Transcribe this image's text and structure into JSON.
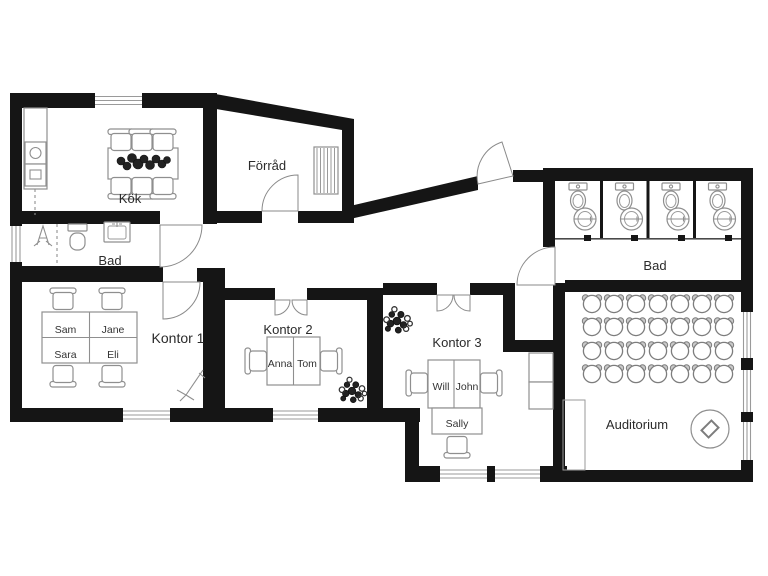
{
  "type": "floor-plan",
  "colors": {
    "wall": "#151515",
    "furniture_stroke": "#8f8f8f",
    "text": "#2b2b2b",
    "background": "#ffffff"
  },
  "rooms": {
    "kok": {
      "label": "Kök"
    },
    "forrad": {
      "label": "Förråd"
    },
    "bad_left": {
      "label": "Bad"
    },
    "kontor1": {
      "label": "Kontor 1",
      "desks": [
        "Sam",
        "Jane",
        "Sara",
        "Eli"
      ]
    },
    "kontor2": {
      "label": "Kontor 2",
      "desks": [
        "Anna",
        "Tom"
      ]
    },
    "kontor3": {
      "label": "Kontor 3",
      "desks": [
        "Will",
        "John",
        "Sally"
      ]
    },
    "bad_right": {
      "label": "Bad",
      "toilet_stalls": 4
    },
    "auditorium": {
      "label": "Auditorium",
      "chair_rows": 4,
      "chairs_per_row": 7
    }
  }
}
